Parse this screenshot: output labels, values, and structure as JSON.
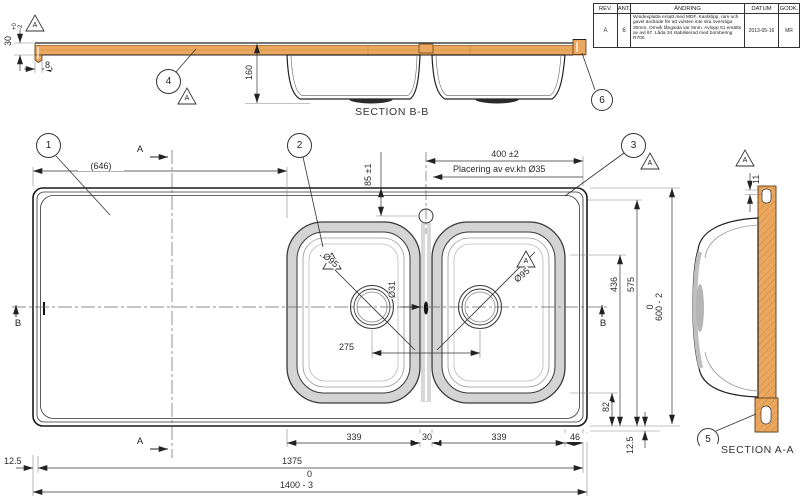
{
  "revision_table": {
    "h_rev": "REV.",
    "h_ant": "ANT.",
    "h_andring": "ÄNDRING",
    "h_datum": "DATUM",
    "h_godk": "GODK.",
    "rev": "A",
    "ant": "6",
    "andring": "Windexplatta ersatt med MDF. Kantklipp, ram och gavel ändrade för att vulsten inte ska överstiga 30mm. Omvik långsida var 9mm. Avlopp 51 ersätts av avl 97. Låda 34 stabiliserad med bombering R700.",
    "datum": "2013-05-16",
    "godk": "MR"
  },
  "sections": {
    "bb": "SECTION B-B",
    "aa": "SECTION A-A"
  },
  "balloons": {
    "b1": "1",
    "b2": "2",
    "b3": "3",
    "b4": "4",
    "b5": "5",
    "b6": "6"
  },
  "datum": {
    "label": "A"
  },
  "cut": {
    "a": "A",
    "b": "B"
  },
  "dims": {
    "thickness": "30",
    "tol_up": "+0",
    "tol_dn": "-2",
    "edge": "8",
    "depth160": "160",
    "len646": "(646)",
    "width400": "400 ±2",
    "offset85": "85 ±1",
    "note": "Placering av ev.kh  Ø35",
    "dia95l": "Ø95",
    "dia95r": "Ø95",
    "dia31": "Ø31",
    "cc275": "275",
    "v436": "436",
    "v575": "575",
    "v600_up": "0",
    "v600": "600 - 2",
    "v82": "82",
    "rim_r": "12.5",
    "rim_l": "12.5",
    "c339a": "339",
    "c30": "30",
    "c339b": "339",
    "c46": "46",
    "len1375": "1375",
    "len1400_up": "0",
    "len1400": "1400 - 3",
    "gap11": "11"
  },
  "colors": {
    "wood": "#EBA75F",
    "rim_gray": "#d4d4d4",
    "line": "#222222"
  }
}
